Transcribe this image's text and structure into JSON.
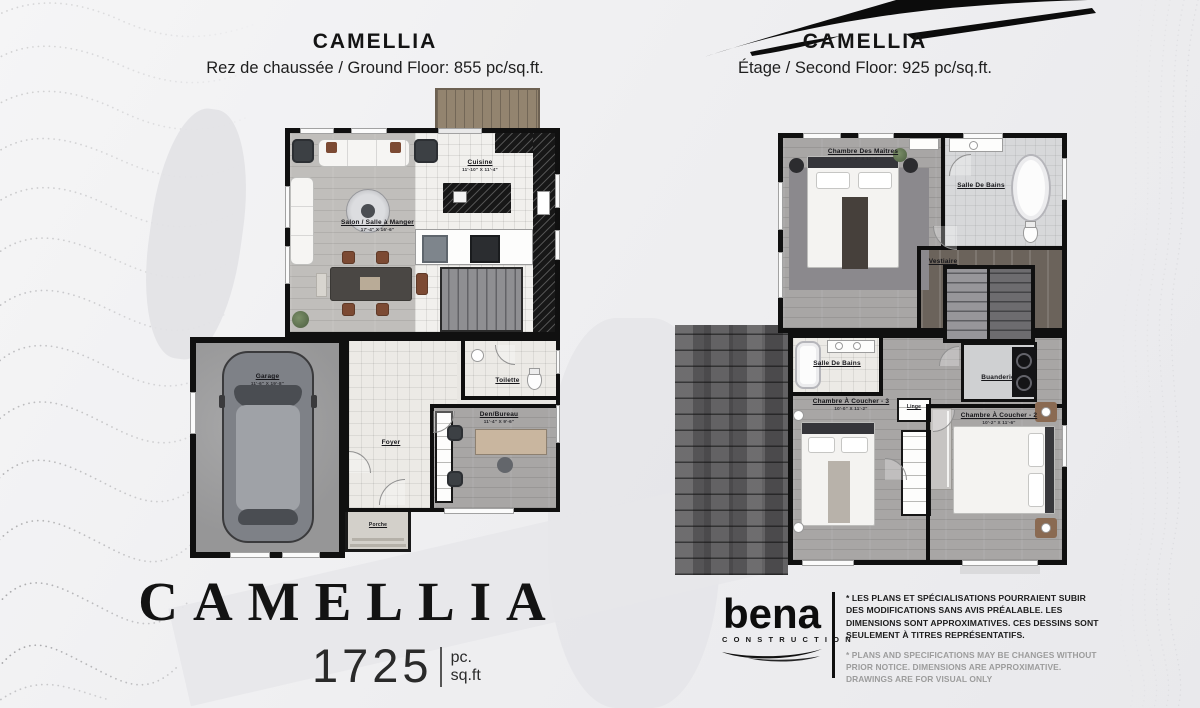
{
  "header_left": {
    "title": "CAMELLIA",
    "subtitle": "Rez de chaussée / Ground Floor: 855 pc/sq.ft."
  },
  "header_right": {
    "title": "CAMELLIA",
    "subtitle": "Étage / Second Floor: 925 pc/sq.ft."
  },
  "ground_floor": {
    "rooms": {
      "cuisine": {
        "name": "Cuisine",
        "dims": "11'-10\" X 11'-4\""
      },
      "salon": {
        "name": "Salon / Salle à Manger",
        "dims": "17'-4\" X 16'-6\""
      },
      "garage": {
        "name": "Garage",
        "dims": "11'-6\" X 19'-8\""
      },
      "foyer": {
        "name": "Foyer"
      },
      "toilette": {
        "name": "Toilette"
      },
      "den": {
        "name": "Den/Bureau",
        "dims": "11'-4\" X 9'-6\""
      },
      "porche": {
        "name": "Porche"
      }
    }
  },
  "second_floor": {
    "rooms": {
      "master": {
        "name": "Chambre Des Maîtres",
        "dims": "13'-2\" X 13'-0\""
      },
      "bath_top": {
        "name": "Salle De Bains"
      },
      "vestiaire": {
        "name": "Vestiaire"
      },
      "bath_mid": {
        "name": "Salle De Bains"
      },
      "bedroom3": {
        "name": "Chambre À Coucher - 3",
        "dims": "10'-0\" X 11'-2\""
      },
      "linge": {
        "name": "Linge"
      },
      "buanderie": {
        "name": "Buanderie"
      },
      "bedroom2": {
        "name": "Chambre À Coucher - 2",
        "dims": "10'-2\" X 11'-6\""
      }
    }
  },
  "branding": {
    "model_name": "CAMELLIA",
    "total_area": "1725",
    "unit_line1": "pc.",
    "unit_line2": "sq.ft"
  },
  "footer": {
    "logo": "bena",
    "logo_sub": "CONSTRUCTION",
    "disclaimer_fr": "* LES PLANS ET SPÉCIALISATIONS POURRAIENT SUBIR DES MODIFICATIONS SANS AVIS PRÉALABLE. LES DIMENSIONS SONT APPROXIMATIVES. CES DESSINS SONT SEULEMENT À TITRES REPRÉSENTATIFS.",
    "disclaimer_en": "* PLANS AND SPECIFICATIONS MAY BE CHANGES WITHOUT PRIOR NOTICE. DIMENSIONS ARE APPROXIMATIVE. DRAWINGS ARE FOR VISUAL ONLY"
  },
  "colors": {
    "ink": "#111111",
    "background": "#efeff1",
    "roof": "#59585a"
  }
}
